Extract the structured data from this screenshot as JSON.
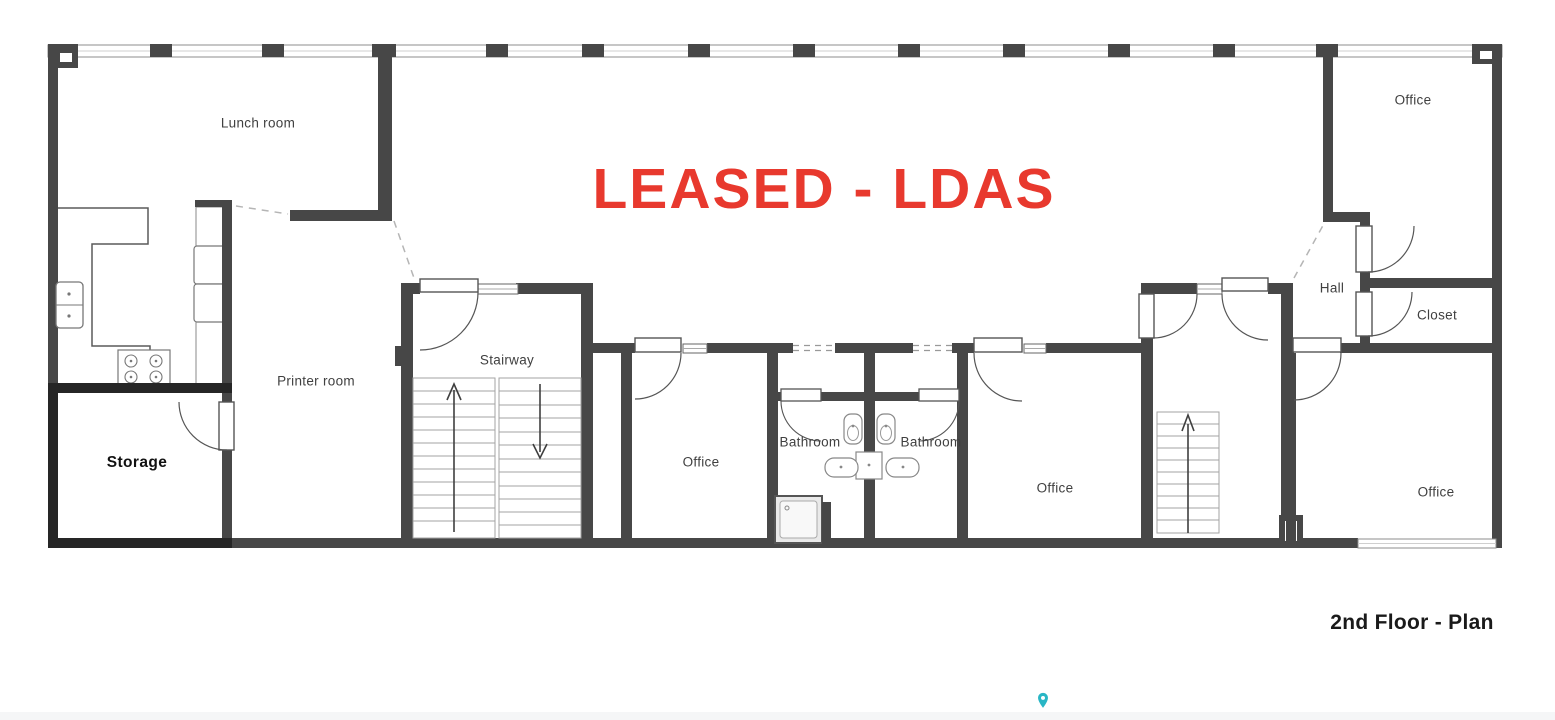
{
  "plan": {
    "title": "2nd Floor - Plan",
    "banner": {
      "text": "LEASED - LDAS",
      "color": "#e8392e"
    },
    "rooms": {
      "lunch_room": "Lunch room",
      "printer_room": "Printer room",
      "storage": "Storage",
      "stairway": "Stairway",
      "office_mid_left": "Office",
      "bathroom_left": "Bathroom",
      "bathroom_right": "Bathroom",
      "office_mid_right": "Office",
      "hall": "Hall",
      "closet": "Closet",
      "office_top_right": "Office",
      "office_bottom_right": "Office"
    },
    "colors": {
      "wall": "#474747",
      "storage_wall": "#262626",
      "banner_red": "#e8392e",
      "pin_teal": "#29b6c5"
    }
  }
}
